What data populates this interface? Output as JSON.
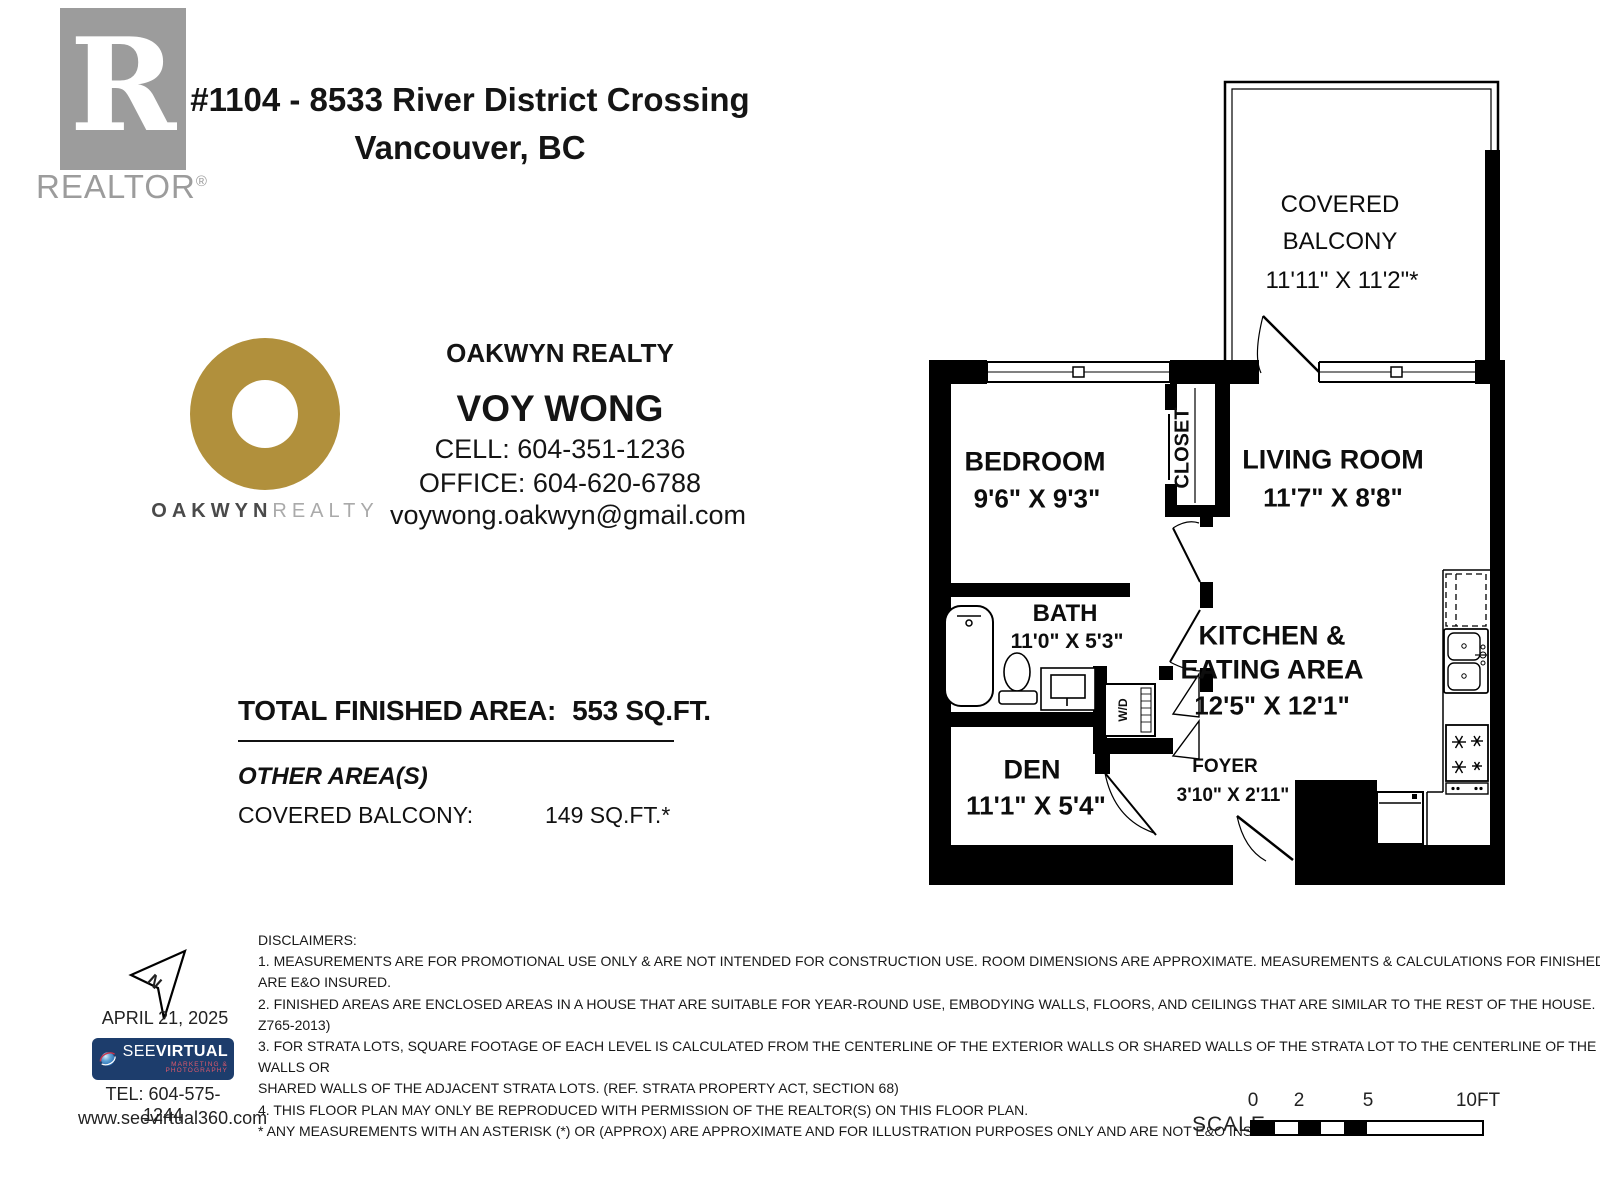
{
  "header": {
    "realtor_letter": "R",
    "realtor_word": "REALTOR",
    "realtor_reg": "®",
    "title_line1": "#1104 - 8533 River District Crossing",
    "title_line2": "Vancouver, BC"
  },
  "brokerage": {
    "wordmark_left": "OAKWYN",
    "wordmark_right": "REALTY"
  },
  "agent": {
    "brand": "OAKWYN REALTY",
    "name": "VOY WONG",
    "cell": "CELL: 604-351-1236",
    "office": "OFFICE: 604-620-6788",
    "email": "voywong.oakwyn@gmail.com"
  },
  "areas": {
    "total_label": "TOTAL FINISHED AREA:",
    "total_value": "553 SQ.FT.",
    "other_heading": "OTHER AREA(S)",
    "other_label": "COVERED BALCONY:",
    "other_value": "149 SQ.FT.*"
  },
  "floorplan": {
    "balcony_l1": "COVERED",
    "balcony_l2": "BALCONY",
    "balcony_dims": "11'11\" X 11'2\"*",
    "bedroom": "BEDROOM",
    "bedroom_dims": "9'6\" X 9'3\"",
    "living": "LIVING ROOM",
    "living_dims": "11'7\" X 8'8\"",
    "closet": "CLOSET",
    "bath": "BATH",
    "bath_dims": "11'0\" X 5'3\"",
    "wd": "W/D",
    "kitchen_l1": "KITCHEN &",
    "kitchen_l2": "EATING AREA",
    "kitchen_dims": "12'5\" X 12'1\"",
    "den": "DEN",
    "den_dims": "11'1\" X 5'4\"",
    "foyer": "FOYER",
    "foyer_dims": "3'10\" X 2'11\""
  },
  "footer": {
    "north_label": "N",
    "date": "APRIL 21, 2025",
    "vendor_see": "SEE",
    "vendor_virtual": "VIRTUAL",
    "vendor_tagline": "MARKETING & PHOTOGRAPHY",
    "tel": "TEL: 604-575-1244",
    "web": "www.seevirtual360.com",
    "scale_label": "SCALE",
    "scale_ticks": [
      "0",
      "2",
      "5",
      "10FT"
    ],
    "disclaimers": [
      "DISCLAIMERS:",
      "1. MEASUREMENTS ARE FOR PROMOTIONAL USE ONLY & ARE NOT INTENDED FOR CONSTRUCTION USE. ROOM DIMENSIONS ARE APPROXIMATE. MEASUREMENTS & CALCULATIONS FOR FINISHED AREAS",
      "ARE E&O INSURED.",
      "2. FINISHED AREAS ARE ENCLOSED AREAS IN A HOUSE THAT ARE SUITABLE FOR YEAR-ROUND USE, EMBODYING WALLS, FLOORS, AND CEILINGS THAT ARE SIMILAR TO THE REST OF THE HOUSE. (ANSI",
      "Z765-2013)",
      "3. FOR STRATA LOTS, SQUARE FOOTAGE OF EACH LEVEL IS CALCULATED FROM THE CENTERLINE OF THE EXTERIOR WALLS OR SHARED WALLS OF THE STRATA LOT TO THE CENTERLINE OF THE EXTERIOR",
      "WALLS OR",
      "SHARED WALLS OF THE ADJACENT STRATA LOTS. (REF. STRATA PROPERTY ACT, SECTION 68)",
      "4. THIS FLOOR PLAN MAY ONLY BE REPRODUCED WITH PERMISSION OF THE REALTOR(S) ON THIS FLOOR PLAN.",
      "* ANY MEASUREMENTS WITH AN ASTERISK (*) OR (APPROX) ARE APPROXIMATE AND FOR ILLUSTRATION PURPOSES ONLY AND ARE NOT E&O INSURED."
    ]
  },
  "colors": {
    "logo_gray": "#9c9c9c",
    "gold": "#b1903c",
    "navy": "#1d3d6c",
    "red": "#e0596b",
    "wall_black": "#000000"
  }
}
